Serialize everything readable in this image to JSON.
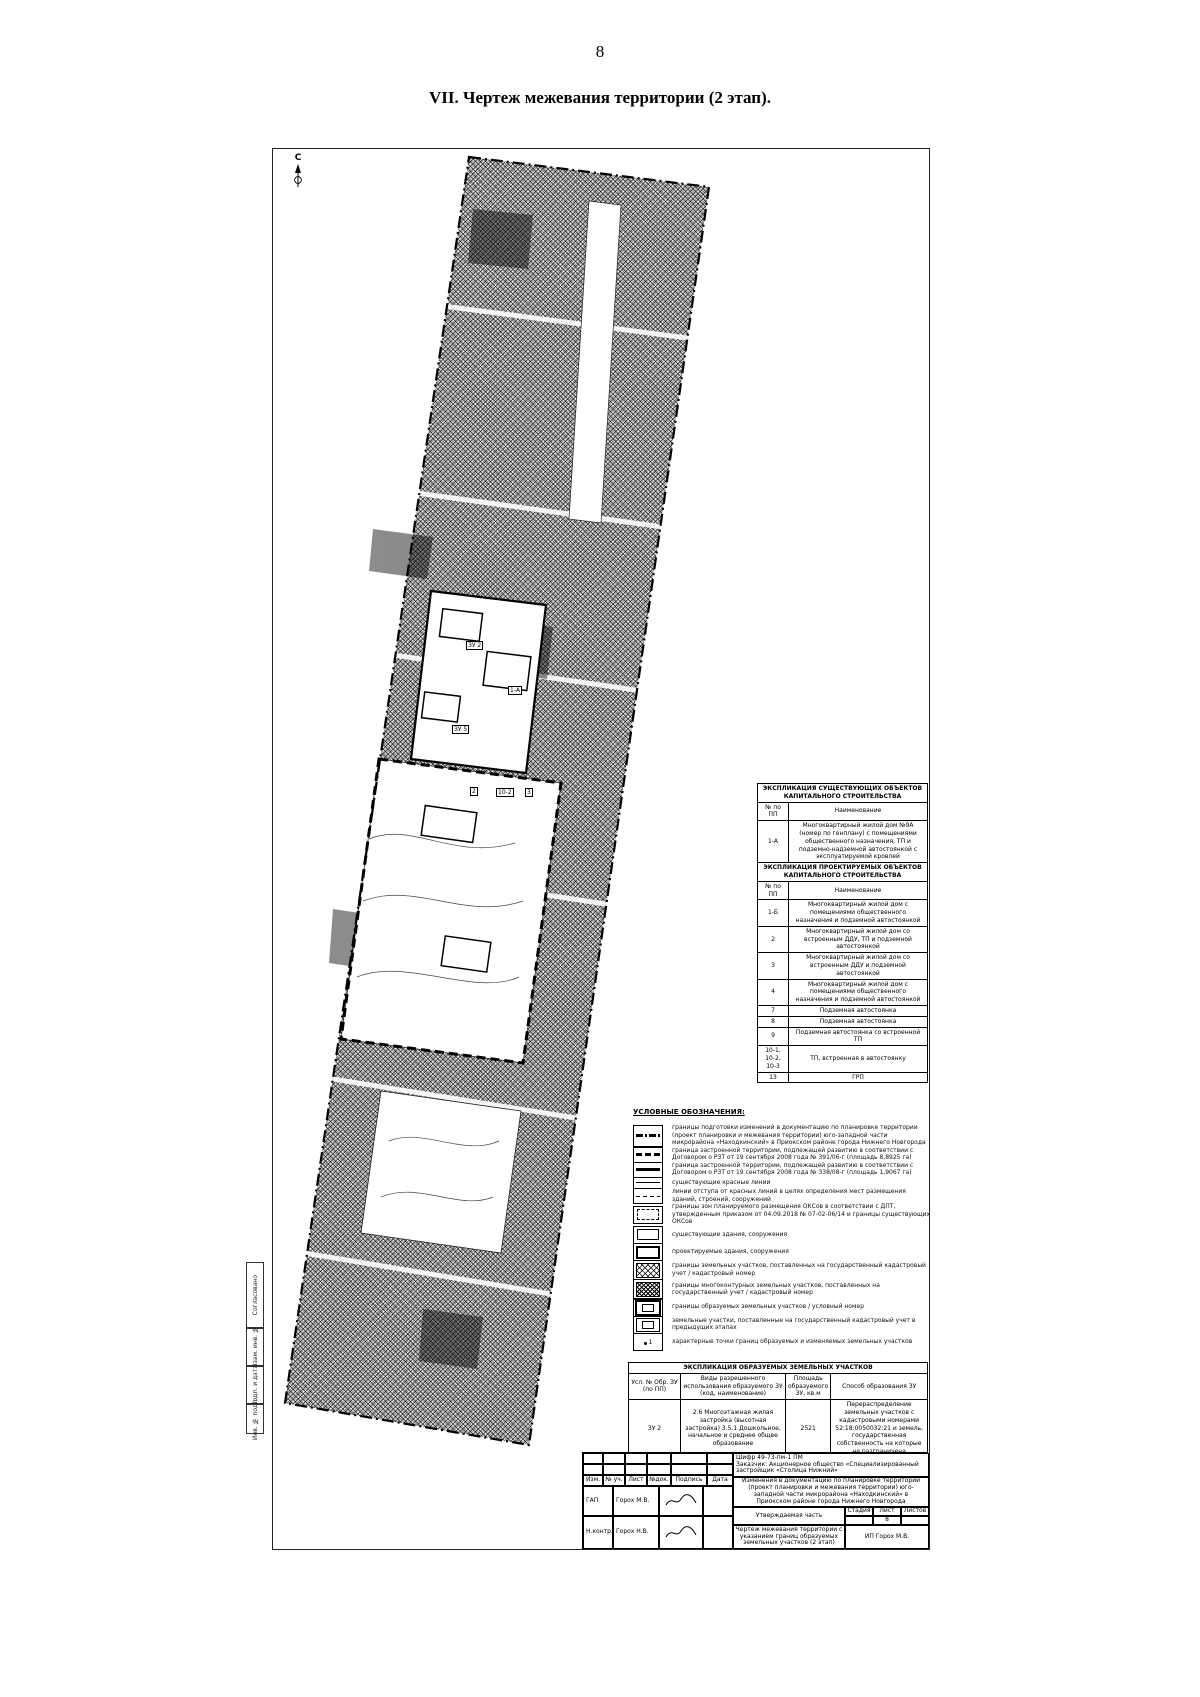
{
  "page": {
    "number": "8",
    "title": "VII.   Чертеж межевания территории (2 этап)."
  },
  "map": {
    "north_label": "С",
    "labels": [
      {
        "text": "ЗУ 2"
      },
      {
        "text": "1-А"
      },
      {
        "text": "ЗУ 5"
      },
      {
        "text": "2"
      },
      {
        "text": "10-2"
      },
      {
        "text": "3"
      }
    ]
  },
  "sidebar": {
    "items": [
      {
        "label": "Согласовано"
      },
      {
        "label": "Взам. инв. №"
      },
      {
        "label": "Подп. и дата"
      },
      {
        "label": "Инв. № подл."
      }
    ]
  },
  "existing_table": {
    "title": "ЭКСПЛИКАЦИЯ СУЩЕСТВУЮЩИХ ОБЪЕКТОВ КАПИТАЛЬНОГО СТРОИТЕЛЬСТВА",
    "col_num": "№ по ПП",
    "col_name": "Наименование",
    "rows": [
      {
        "num": "1-А",
        "name": "Многоквартирный жилой дом №9А (номер по генплану) с помещениями общественного назначения, ТП и подземно-надземной автостоянкой с эксплуатируемой кровлей"
      }
    ]
  },
  "projected_table": {
    "title": "ЭКСПЛИКАЦИЯ ПРОЕКТИРУЕМЫХ ОБЪЕКТОВ КАПИТАЛЬНОГО СТРОИТЕЛЬСТВА",
    "col_num": "№ по ПП",
    "col_name": "Наименование",
    "rows": [
      {
        "num": "1-Б",
        "name": "Многоквартирный жилой дом с помещениями общественного назначения и подземной автостоянкой"
      },
      {
        "num": "2",
        "name": "Многоквартирный жилой дом со встроенным ДДУ, ТП и подземной автостоянкой"
      },
      {
        "num": "3",
        "name": "Многоквартирный жилой дом со встроенным ДДУ и подземной автостоянкой"
      },
      {
        "num": "4",
        "name": "Многоквартирный жилой дом с помещениями общественного назначения и подземной автостоянкой"
      },
      {
        "num": "7",
        "name": "Подземная автостоянка"
      },
      {
        "num": "8",
        "name": "Подземная автостоянка"
      },
      {
        "num": "9",
        "name": "Подземная автостоянка со встроенной ТП"
      },
      {
        "num": "10-1, 10-2, 10-3",
        "name": "ТП, встроенная в автостоянку"
      },
      {
        "num": "13",
        "name": "ГРП"
      }
    ]
  },
  "legend": {
    "title": "УСЛОВНЫЕ ОБОЗНАЧЕНИЯ:",
    "point_label": "1",
    "items": [
      {
        "label": "границы подготовки изменений в документацию по планировке территории (проект планировки и межевания территории) юго-западной части микрорайона «Находкинский» в Приокском районе города Нижнего Новгорода"
      },
      {
        "label": "граница застроенной территории, подлежащей развитию в соответствии с Договором о РЗТ от 19 сентября 2008 года № 391/06-г (площадь 8,8925 га)"
      },
      {
        "label": "граница застроенной территории, подлежащей развитию в соответствии с Договором о РЗТ от 19 сентября 2008 года № 338/08-г (площадь 1,9067 га)"
      },
      {
        "label": "существующие красные линии"
      },
      {
        "label": "линии отступа от красных линий в целях определения мест размещения зданий, строений, сооружений"
      },
      {
        "label": "границы зон планируемого размещения ОКСов в соответствии с ДПТ, утвержденным приказом от 04.09.2018 № 07-02-06/14 и границы существующих ОКСов"
      },
      {
        "label": "существующие здания, сооружения"
      },
      {
        "label": "проектируемые здания, сооружения"
      },
      {
        "label": "границы земельных участков, поставленных на государственный кадастровый учет / кадастровый номер"
      },
      {
        "label": "границы многоконтурных земельных участков, поставленных на государственный учет / кадастровый номер"
      },
      {
        "label": "границы образуемых земельных участков / условный номер"
      },
      {
        "label": "земельные участки, поставленные на государственный кадастровый учет в предыдущих этапах"
      },
      {
        "label": "характерные точки границ образуемых и изменяемых земельных участков"
      }
    ]
  },
  "parcels_table": {
    "title": "ЭКСПЛИКАЦИЯ ОБРАЗУЕМЫХ ЗЕМЕЛЬНЫХ УЧАСТКОВ",
    "cols": [
      "Усл. № Обр. ЗУ (по ПП)",
      "Виды разрешенного использования образуемого ЗУ (код, наименование)",
      "Площадь образуемого ЗУ, кв.м",
      "Способ образования ЗУ"
    ],
    "rows": [
      {
        "num": "ЗУ 2",
        "use": "2.6 Многоэтажная жилая застройка (высотная застройка) 3.5.1 Дошкольное, начальное и среднее общее образование",
        "area": "2521",
        "method": "Перераспределение земельных участков с кадастровыми номерами 52:18:0050032:21 и земель, государственная собственность на которые не разграничена"
      },
      {
        "num": "ЗУ 5",
        "use": "2.7.1 Хранение автотранспорта",
        "area": "942",
        "method": "Перераспределение земельных участков с кадастровыми номерами 52:18:0050032:19 и земель, государственная собственность на которые не разграничена"
      }
    ]
  },
  "stamp": {
    "shifr": "Шифр 49-73-пм-1 ПМ",
    "customer": "Заказчик: Акционерное общество «Специализированный застройщик «Столица Нижний»",
    "description": "Изменения в документацию по планировке территории (проект планировки и межевания территории) юго-западной части микрорайона «Находкинский» в Приокском районе города Нижнего Новгорода",
    "cols": [
      "Изм.",
      "№ уч.",
      "Лист",
      "№док.",
      "Подпись",
      "Дата"
    ],
    "row1_role": "ГАП",
    "row1_name": "Горох М.В.",
    "row2_role": "Н.контр.",
    "row2_name": "Горох Н.В.",
    "center1": "Утверждаемая часть",
    "center2": "Чертеж межевания территории с указанием границ образуемых земельных участков (2 этап)",
    "stage_col": "Стадия",
    "sheet_col": "Лист",
    "sheets_col": "Листов",
    "sheet_val": "8",
    "org": "ИП Горох М.В."
  }
}
